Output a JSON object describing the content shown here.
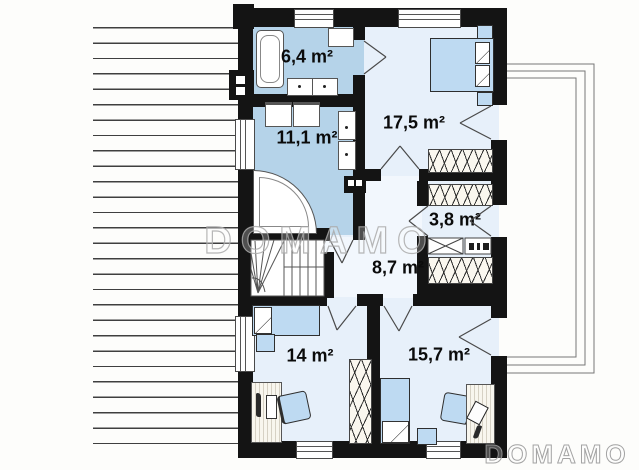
{
  "plan": {
    "kind": "upper-floor-plan",
    "features": [
      "terrace-decking-left",
      "balcony-roof-outline-right",
      "winder-staircase"
    ]
  },
  "rooms": [
    {
      "key": "bathroom-small",
      "area_label": "6,4 m²"
    },
    {
      "key": "bathroom-large",
      "area_label": "11,1 m²"
    },
    {
      "key": "bedroom-master",
      "area_label": "17,5 m²"
    },
    {
      "key": "wardrobe",
      "area_label": "3,8 m²"
    },
    {
      "key": "hall",
      "area_label": "8,7 m²"
    },
    {
      "key": "bedroom-left",
      "area_label": "14 m²"
    },
    {
      "key": "bedroom-right",
      "area_label": "15,7 m²"
    }
  ],
  "watermarks": {
    "center": "DOMAMO",
    "bottom_right": "DOMAMO"
  },
  "colors": {
    "wall": "#141414",
    "bathroom_floor": "#b5d3e9",
    "room_floor": "#e7f0fa",
    "hall_floor": "#f2f7fd",
    "furniture_blue": "#bedaf2",
    "watermark_outline": "#aaaaaa"
  }
}
